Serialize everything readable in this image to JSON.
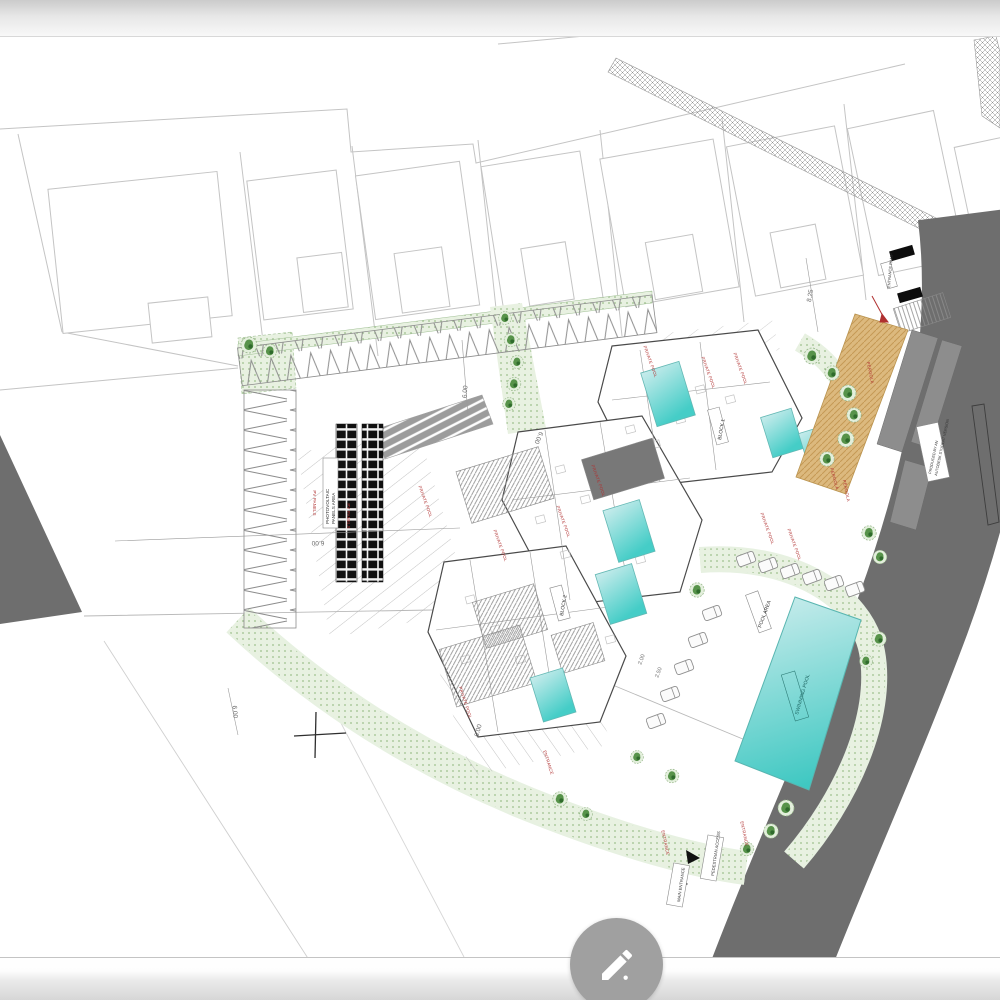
{
  "fab": {
    "icon": "pencil-icon"
  },
  "plan": {
    "dimensions": {
      "d1": "6.00",
      "d2": "6.00",
      "d3": "6.00",
      "d4": "6.00",
      "d5": "8.25",
      "d6": "2.00",
      "d7": "2.50",
      "d8": "6.00"
    },
    "labels": {
      "photovoltaic_1": "PHOTOVOLTAIC",
      "photovoltaic_2": "PANELS AREA",
      "block1": "BLOCK 1",
      "block2": "BLOCK 2",
      "pool_area": "POOL AREA",
      "swimming_pool": "SWIMMING POOL",
      "pedestrian_access": "PEDESTRIAN ACCESS",
      "main_entrance": "MAIN ENTRANCE",
      "entrance_ramp": "ENTRANCE RAMP",
      "road_note_1": "PRODUCED BY AN",
      "road_note_2": "AUTODESK STUDENT VERSION"
    },
    "red_annotations": {
      "r1": "PV PANELS",
      "r2": "PV PANELS",
      "r3": "PRIVATE POOL",
      "r4": "PRIVATE POOL",
      "r5": "PRIVATE POOL",
      "r6": "PRIVATE POOL",
      "r7": "PRIVATE POOL",
      "r8": "PRIVATE POOL",
      "r9": "PRIVATE POOL",
      "r10": "PRIVATE POOL",
      "r11": "PRIVATE POOL",
      "r12": "PERGOLA",
      "r13": "PERGOLA",
      "r14": "PERGOLA",
      "r15": "PRIVATE POOL",
      "r16": "ENTRANCE",
      "r17": "ENTRANCE",
      "r18": "ENTRANCE"
    },
    "colors": {
      "road": "#6e6e6e",
      "pool_light": "#c9ecec",
      "pool_deep": "#45cdc7",
      "pergola": "#dcb97e",
      "tree": "#57934a",
      "annotation": "#b03030",
      "dimension": "#6b6b6b"
    }
  }
}
